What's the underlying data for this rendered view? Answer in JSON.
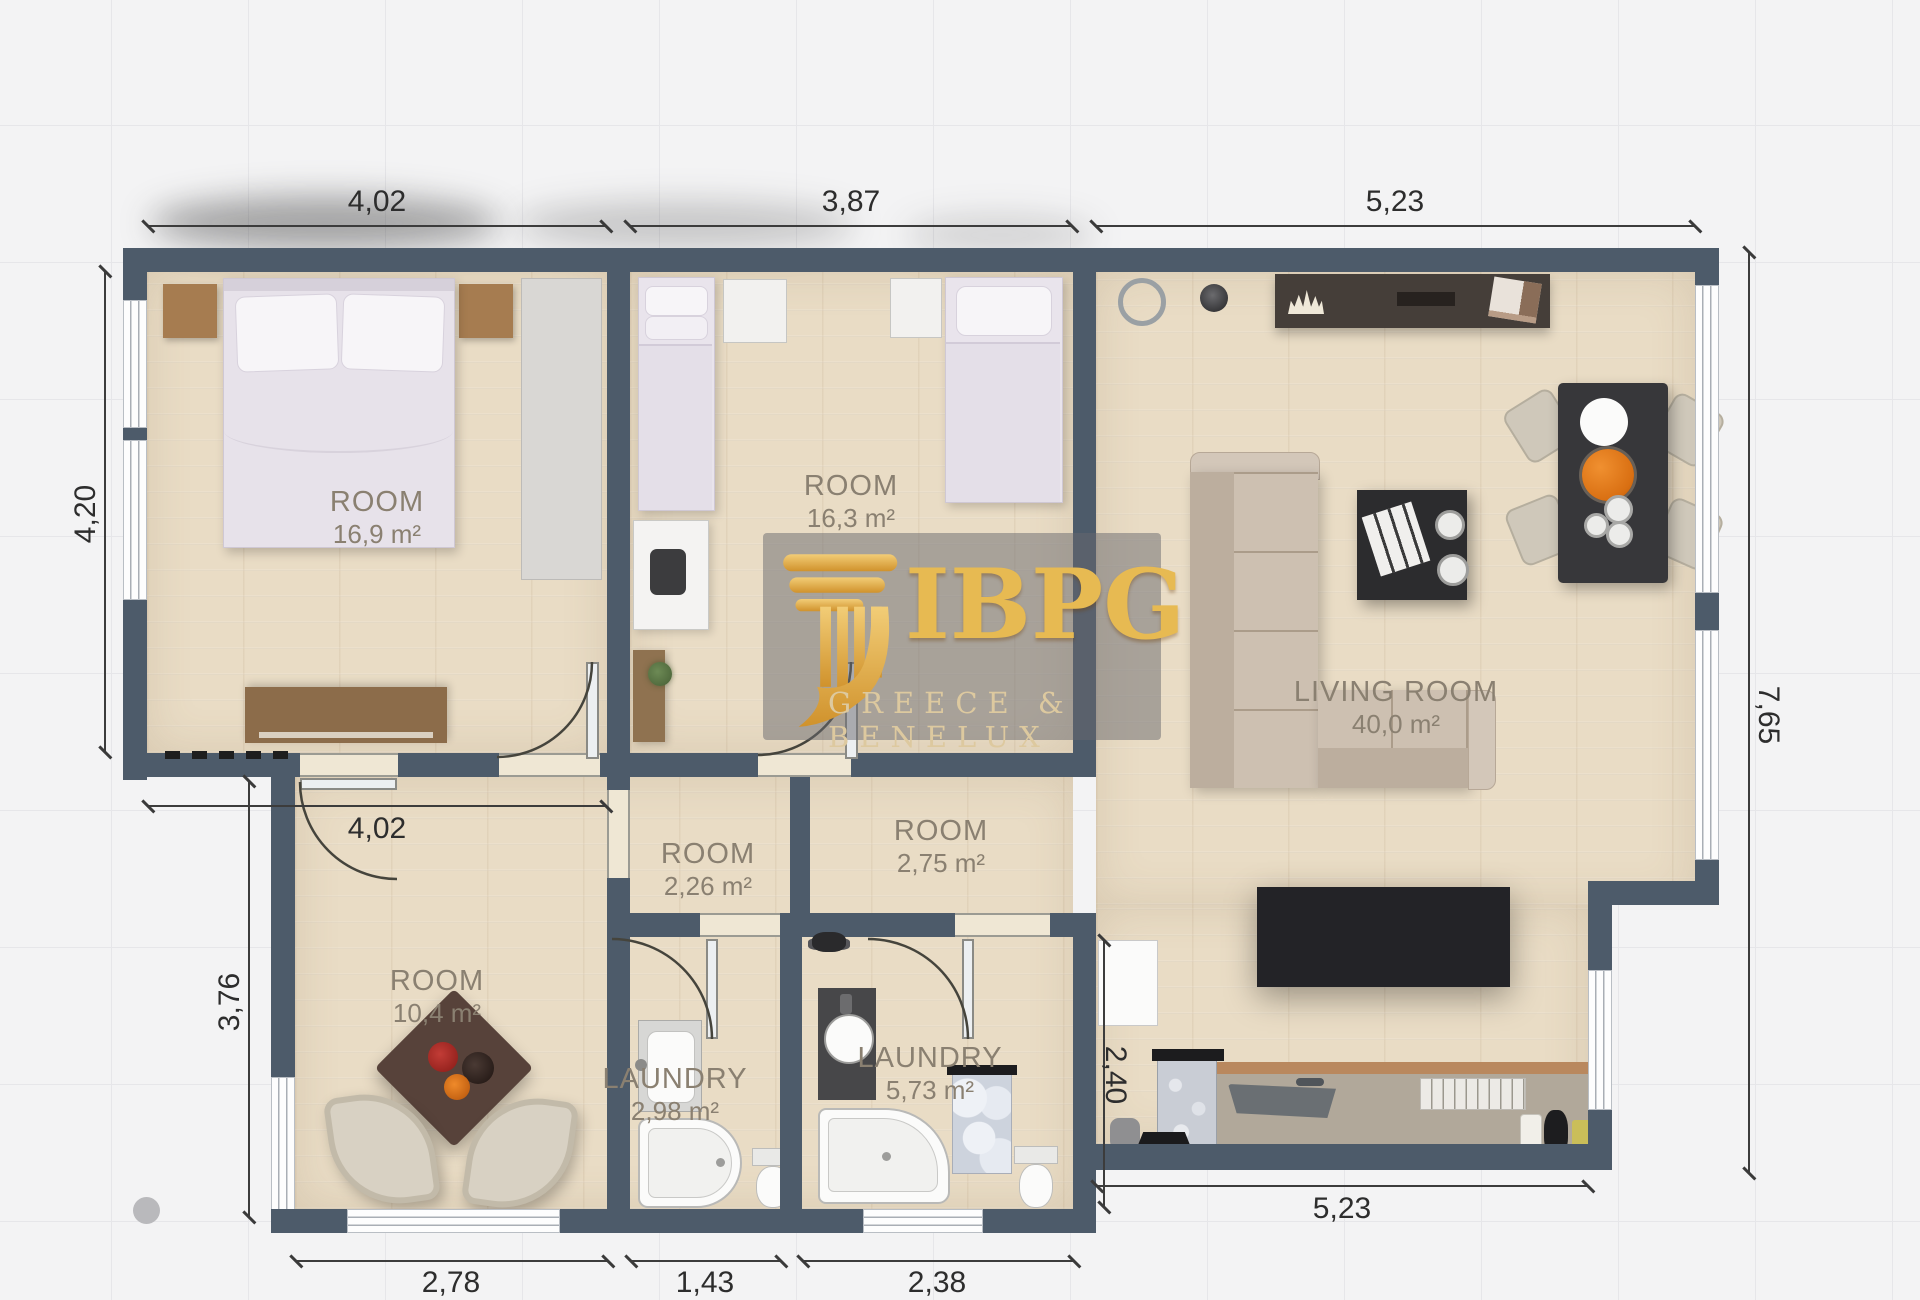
{
  "plan": {
    "watermark": {
      "brand": "IBPG",
      "subtitle": "GREECE & BENELUX"
    },
    "rooms": [
      {
        "name": "ROOM",
        "area": "16,9 m²"
      },
      {
        "name": "ROOM",
        "area": "16,3 m²"
      },
      {
        "name": "LIVING ROOM",
        "area": "40,0 m²"
      },
      {
        "name": "ROOM",
        "area": "2,26 m²"
      },
      {
        "name": "ROOM",
        "area": "2,75 m²"
      },
      {
        "name": "ROOM",
        "area": "10,4 m²"
      },
      {
        "name": "LAUNDRY",
        "area": "2,98 m²"
      },
      {
        "name": "LAUNDRY",
        "area": "5,73 m²"
      }
    ],
    "dimensions": {
      "top_left": "4,02",
      "top_middle": "3,87",
      "top_right": "5,23",
      "left_upper": "4,20",
      "left_lower": "3,76",
      "right_side": "7,65",
      "hall_width": "4,02",
      "kitchen_depth": "2,40",
      "bottom_room": "2,78",
      "bottom_laundry_small": "1,43",
      "bottom_laundry_large": "2,38",
      "bottom_kitchen": "5,23"
    },
    "colors": {
      "wall": "#4d5b6a",
      "floor": "#e9dcc5",
      "gold": "#e7ba52",
      "label": "#8a8071"
    }
  }
}
